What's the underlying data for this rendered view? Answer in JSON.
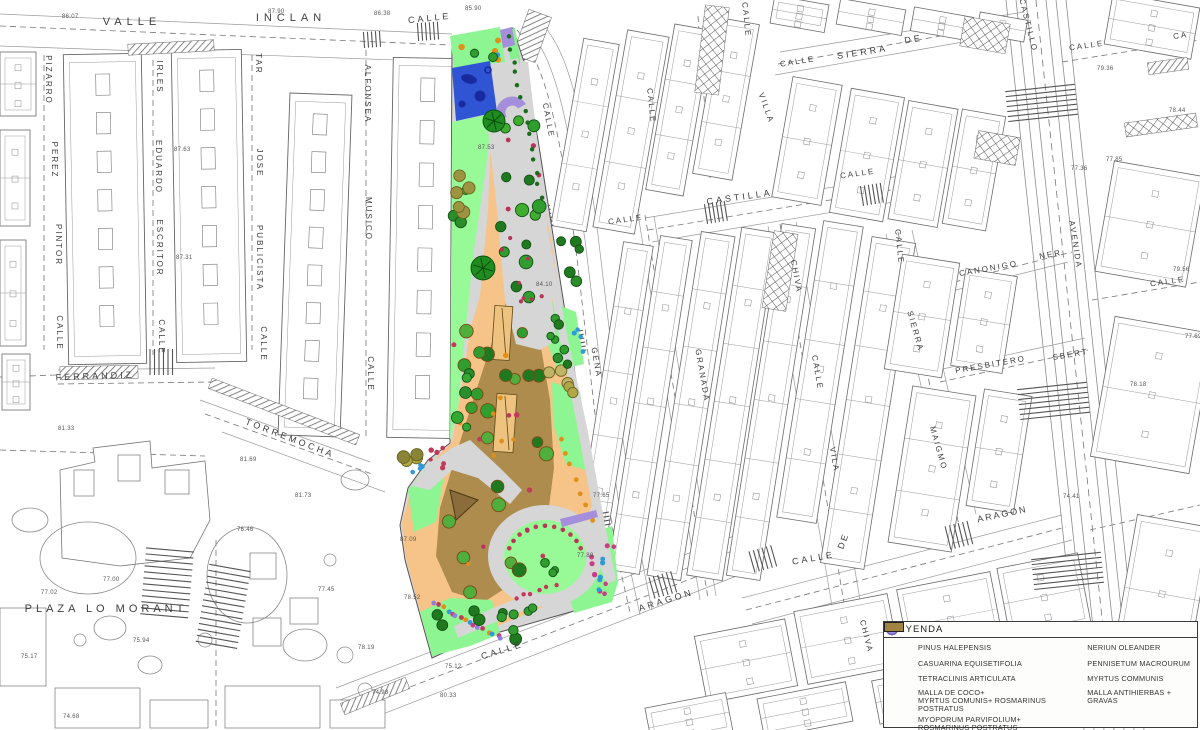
{
  "legend": {
    "title": "LEYENDA",
    "left": [
      {
        "icon": "pinus-halepensis",
        "label": "PINUS HALEPENSIS"
      },
      {
        "icon": "casuarina",
        "label": "CASUARINA EQUISETIFOLIA"
      },
      {
        "icon": "tetraclinis",
        "label": "TETRACLINIS ARTICULATA"
      },
      {
        "icon": "swatch-coco",
        "label": "MALLA DE COCO+",
        "label2": "MYRTUS COMUNIS+ ROSMARINUS POSTRATUS"
      },
      {
        "icon": "swatch-myoporum",
        "label": "MYOPORUM PARVIFOLIUM+ ROSMARINUS POSTRATUS"
      }
    ],
    "right": [
      {
        "icon": "nerium",
        "label": "NERIUN OLEANDER"
      },
      {
        "icon": "pennisetum",
        "label": "PENNISETUM MACROURUM"
      },
      {
        "icon": "myrtus",
        "label": "MYRTUS COMMUNIS"
      },
      {
        "icon": "swatch-gravas",
        "label": "MALLA ANTIHIERBAS + GRAVAS"
      }
    ],
    "icon_colors": {
      "pinus-halepensis": "#3f9e28",
      "pinus-stroke": "#1d5a12",
      "casuarina": "#ffffff",
      "casuarina-stroke": "#2d7a2d",
      "tetraclinis": "#6b6b22",
      "tetraclinis-stroke": "#3a3a10",
      "nerium": "#a83a5c",
      "nerium-stroke": "#6e1f38",
      "pennisetum": "#e09018",
      "pennisetum-stroke": "#9a6010",
      "myrtus": "#9f8fe3",
      "myrtus-stroke": "#6f5fc0",
      "swatch-coco": "#b5a057",
      "swatch-myoporum": "#14c24a",
      "swatch-gravas": "#a08243"
    }
  },
  "map": {
    "street_labels": [
      {
        "t": "VALLE",
        "x": 132,
        "y": 25,
        "r": 0,
        "s": 11,
        "ls": 5
      },
      {
        "t": "INCLAN",
        "x": 291,
        "y": 21,
        "r": 0,
        "s": 11,
        "ls": 5
      },
      {
        "t": "CALLE",
        "x": 430,
        "y": 21,
        "r": -6,
        "s": 9,
        "ls": 3
      },
      {
        "t": "PIZARRO",
        "x": 46,
        "y": 80,
        "r": 90,
        "s": 8,
        "ls": 2
      },
      {
        "t": "PEREZ",
        "x": 52,
        "y": 160,
        "r": 90,
        "s": 8,
        "ls": 2
      },
      {
        "t": "PINTOR",
        "x": 56,
        "y": 245,
        "r": 90,
        "s": 8,
        "ls": 2
      },
      {
        "t": "CALLE",
        "x": 57,
        "y": 333,
        "r": 90,
        "s": 8,
        "ls": 2
      },
      {
        "t": "IRLES",
        "x": 157,
        "y": 77,
        "r": 90,
        "s": 8,
        "ls": 2
      },
      {
        "t": "EDUARDO",
        "x": 156,
        "y": 167,
        "r": 90,
        "s": 8,
        "ls": 2
      },
      {
        "t": "ESCRITOR",
        "x": 157,
        "y": 248,
        "r": 90,
        "s": 8,
        "ls": 2
      },
      {
        "t": "CALLE",
        "x": 159,
        "y": 337,
        "r": 90,
        "s": 8,
        "ls": 2
      },
      {
        "t": "TAR",
        "x": 256,
        "y": 64,
        "r": 90,
        "s": 8,
        "ls": 2
      },
      {
        "t": "JOSE",
        "x": 257,
        "y": 163,
        "r": 90,
        "s": 8,
        "ls": 2
      },
      {
        "t": "PUBLICISTA",
        "x": 257,
        "y": 258,
        "r": 90,
        "s": 8,
        "ls": 2
      },
      {
        "t": "CALLE",
        "x": 261,
        "y": 344,
        "r": 90,
        "s": 8,
        "ls": 2
      },
      {
        "t": "ALFONSEA",
        "x": 365,
        "y": 94,
        "r": 90,
        "s": 8,
        "ls": 2
      },
      {
        "t": "MUSICO",
        "x": 366,
        "y": 219,
        "r": 90,
        "s": 8,
        "ls": 2
      },
      {
        "t": "CALLE",
        "x": 368,
        "y": 374,
        "r": 90,
        "s": 8,
        "ls": 2
      },
      {
        "t": "FERRANDIZ",
        "x": 95,
        "y": 379,
        "r": -2,
        "s": 9,
        "ls": 3
      },
      {
        "t": "TORREMOCHA",
        "x": 289,
        "y": 441,
        "r": 21,
        "s": 9,
        "ls": 3
      },
      {
        "t": "PLAZA LO MORANT",
        "x": 106,
        "y": 612,
        "r": 0,
        "s": 11,
        "ls": 4
      },
      {
        "t": "CALLE",
        "x": 546,
        "y": 121,
        "r": 79,
        "s": 8,
        "ls": 2
      },
      {
        "t": "GENA",
        "x": 594,
        "y": 363,
        "r": 80,
        "s": 8,
        "ls": 2
      },
      {
        "t": "CALLE",
        "x": 626,
        "y": 222,
        "r": -8,
        "s": 8,
        "ls": 2
      },
      {
        "t": "CALLE",
        "x": 649,
        "y": 106,
        "r": 84,
        "s": 8,
        "ls": 2
      },
      {
        "t": "CALLE",
        "x": 744,
        "y": 20,
        "r": 84,
        "s": 8,
        "ls": 2
      },
      {
        "t": "SIERRA",
        "x": 863,
        "y": 55,
        "r": -9,
        "s": 9,
        "ls": 3
      },
      {
        "t": "DE",
        "x": 914,
        "y": 42,
        "r": -9,
        "s": 9,
        "ls": 3
      },
      {
        "t": "CALLE",
        "x": 798,
        "y": 64,
        "r": -9,
        "s": 8,
        "ls": 2
      },
      {
        "t": "VILLA",
        "x": 764,
        "y": 109,
        "r": 70,
        "s": 8,
        "ls": 2
      },
      {
        "t": "CALLE",
        "x": 858,
        "y": 176,
        "r": -8,
        "s": 8,
        "ls": 2
      },
      {
        "t": "CASTILLA",
        "x": 740,
        "y": 200,
        "r": -8,
        "s": 9,
        "ls": 3
      },
      {
        "t": "CASTILLO",
        "x": 1026,
        "y": 26,
        "r": 76,
        "s": 8,
        "ls": 2
      },
      {
        "t": "CALLE",
        "x": 1087,
        "y": 48,
        "r": -8,
        "s": 8,
        "ls": 2
      },
      {
        "t": "CA",
        "x": 1181,
        "y": 38,
        "r": -8,
        "s": 8,
        "ls": 2
      },
      {
        "t": "CALLE",
        "x": 1168,
        "y": 284,
        "r": -8,
        "s": 8,
        "ls": 2
      },
      {
        "t": "CALLE",
        "x": 897,
        "y": 247,
        "r": 84,
        "s": 8,
        "ls": 2
      },
      {
        "t": "SIERRA",
        "x": 913,
        "y": 332,
        "r": 74,
        "s": 8,
        "ls": 2
      },
      {
        "t": "MAIGMO",
        "x": 936,
        "y": 449,
        "r": 74,
        "s": 8,
        "ls": 2
      },
      {
        "t": "GRANADA",
        "x": 700,
        "y": 376,
        "r": 80,
        "s": 8,
        "ls": 2
      },
      {
        "t": "CHIVA",
        "x": 794,
        "y": 277,
        "r": 80,
        "s": 8,
        "ls": 2
      },
      {
        "t": "CALLE",
        "x": 815,
        "y": 373,
        "r": 80,
        "s": 8,
        "ls": 2
      },
      {
        "t": "VILA",
        "x": 832,
        "y": 460,
        "r": 80,
        "s": 8,
        "ls": 2
      },
      {
        "t": "CANONIGO",
        "x": 989,
        "y": 271,
        "r": -10,
        "s": 8,
        "ls": 2
      },
      {
        "t": "NER",
        "x": 1051,
        "y": 257,
        "r": -10,
        "s": 8,
        "ls": 2
      },
      {
        "t": "PRESBITERO",
        "x": 991,
        "y": 367,
        "r": -10,
        "s": 8,
        "ls": 2
      },
      {
        "t": "SBERT",
        "x": 1071,
        "y": 357,
        "r": -10,
        "s": 8,
        "ls": 2
      },
      {
        "t": "AVENIDA",
        "x": 1073,
        "y": 245,
        "r": 81,
        "s": 8,
        "ls": 2
      },
      {
        "t": "CALLE",
        "x": 503,
        "y": 653,
        "r": -17,
        "s": 9,
        "ls": 3
      },
      {
        "t": "ARAGON",
        "x": 667,
        "y": 603,
        "r": -17,
        "s": 9,
        "ls": 3
      },
      {
        "t": "CALLE",
        "x": 814,
        "y": 561,
        "r": -10,
        "s": 9,
        "ls": 3
      },
      {
        "t": "DE",
        "x": 846,
        "y": 542,
        "r": -70,
        "s": 9,
        "ls": 2
      },
      {
        "t": "ARAGON",
        "x": 1003,
        "y": 517,
        "r": -12,
        "s": 9,
        "ls": 2
      },
      {
        "t": "CHIVA",
        "x": 864,
        "y": 637,
        "r": 76,
        "s": 8,
        "ls": 2
      }
    ],
    "elevations": [
      {
        "t": "86.07",
        "x": 62,
        "y": 18
      },
      {
        "t": "87.90",
        "x": 268,
        "y": 13
      },
      {
        "t": "86.38",
        "x": 374,
        "y": 15
      },
      {
        "t": "85.90",
        "x": 465,
        "y": 10
      },
      {
        "t": "87.63",
        "x": 174,
        "y": 151
      },
      {
        "t": "87.31",
        "x": 176,
        "y": 259
      },
      {
        "t": "81.33",
        "x": 58,
        "y": 430
      },
      {
        "t": "81.69",
        "x": 240,
        "y": 461
      },
      {
        "t": "81.73",
        "x": 295,
        "y": 497
      },
      {
        "t": "77.00",
        "x": 103,
        "y": 581
      },
      {
        "t": "77.02",
        "x": 41,
        "y": 594
      },
      {
        "t": "75.94",
        "x": 133,
        "y": 642
      },
      {
        "t": "75.17",
        "x": 21,
        "y": 658
      },
      {
        "t": "74.68",
        "x": 63,
        "y": 718
      },
      {
        "t": "76.46",
        "x": 237,
        "y": 531
      },
      {
        "t": "77.45",
        "x": 318,
        "y": 591
      },
      {
        "t": "78.19",
        "x": 358,
        "y": 649
      },
      {
        "t": "74.98",
        "x": 372,
        "y": 694
      },
      {
        "t": "78.52",
        "x": 404,
        "y": 599
      },
      {
        "t": "87.09",
        "x": 400,
        "y": 541
      },
      {
        "t": "80.33",
        "x": 440,
        "y": 697
      },
      {
        "t": "84.10",
        "x": 536,
        "y": 286
      },
      {
        "t": "77.80",
        "x": 577,
        "y": 557
      },
      {
        "t": "87.53",
        "x": 478,
        "y": 149
      },
      {
        "t": "75.12",
        "x": 445,
        "y": 668
      },
      {
        "t": "79.36",
        "x": 1097,
        "y": 70
      },
      {
        "t": "78.44",
        "x": 1169,
        "y": 112
      },
      {
        "t": "77.85",
        "x": 1106,
        "y": 161
      },
      {
        "t": "77.36",
        "x": 1071,
        "y": 170
      },
      {
        "t": "79.56",
        "x": 1173,
        "y": 271
      },
      {
        "t": "77.69",
        "x": 1185,
        "y": 338
      },
      {
        "t": "78.18",
        "x": 1130,
        "y": 386
      },
      {
        "t": "74.41",
        "x": 1063,
        "y": 498
      },
      {
        "t": "77.65",
        "x": 593,
        "y": 497
      }
    ]
  },
  "park": {
    "colors": {
      "path": "#d6d6d6",
      "lawn": "#97fa97",
      "lawn2": "#8ef593",
      "orange": "#f6c488",
      "gravel": "#ad8c4e",
      "play": "#2f55d4",
      "play_dark": "#182a9e",
      "purple": "#a58fdc",
      "pergola": "#eec37f"
    },
    "clusters": [
      {
        "n": 16,
        "x": 492,
        "y": 115,
        "w": 50,
        "h": 212,
        "r0": 4.5,
        "r1": 7,
        "c": [
          "#2f9e2f",
          "#1f7a1f",
          "#3fae2f"
        ],
        "s": "#145214"
      },
      {
        "n": 12,
        "x": 494,
        "y": 120,
        "w": 48,
        "h": 198,
        "r0": 1.8,
        "r1": 2.6,
        "c": [
          "#b8325a"
        ]
      },
      {
        "n": 22,
        "x": 448,
        "y": 318,
        "w": 100,
        "h": 276,
        "r0": 5,
        "r1": 7.5,
        "c": [
          "#2f9e2f",
          "#1f7a1f",
          "#4fae3c"
        ],
        "s": "#7a4a16"
      },
      {
        "n": 9,
        "x": 452,
        "y": 322,
        "w": 95,
        "h": 266,
        "r0": 2,
        "r1": 2.8,
        "c": [
          "#b8325a",
          "#c23a5a"
        ]
      },
      {
        "n": 8,
        "x": 455,
        "y": 332,
        "w": 90,
        "h": 246,
        "r0": 2,
        "r1": 2.8,
        "c": [
          "#e09018"
        ]
      },
      {
        "n": 8,
        "x": 452,
        "y": 138,
        "w": 26,
        "h": 296,
        "r0": 4,
        "r1": 6,
        "c": [
          "#33a833",
          "#2a8f2a"
        ],
        "s": "#145214"
      },
      {
        "n": 5,
        "x": 448,
        "y": 156,
        "w": 28,
        "h": 58,
        "r0": 5,
        "r1": 6.5,
        "c": [
          "#b0a847",
          "#9c9440"
        ],
        "s": "#6b6420"
      },
      {
        "n": 4,
        "x": 398,
        "y": 430,
        "w": 30,
        "h": 32,
        "r0": 5,
        "r1": 6.5,
        "c": [
          "#b0a847",
          "#8a8438"
        ],
        "s": "#6b6420"
      },
      {
        "n": 5,
        "x": 546,
        "y": 368,
        "w": 32,
        "h": 36,
        "r0": 5,
        "r1": 6.5,
        "c": [
          "#b0a847",
          "#c0b467"
        ],
        "s": "#6b6420"
      },
      {
        "n": 4,
        "x": 548,
        "y": 306,
        "w": 26,
        "h": 48,
        "r0": 3.5,
        "r1": 4.5,
        "c": [
          "#2f9e2f"
        ],
        "s": "#145214"
      },
      {
        "row": 1,
        "n": 14,
        "x1": 509,
        "y1": 36,
        "x2": 541,
        "y2": 198,
        "r": 2.2,
        "c": [
          "#1b6b1b"
        ]
      },
      {
        "row": 1,
        "n": 7,
        "x1": 560,
        "y1": 438,
        "x2": 592,
        "y2": 520,
        "r": 2.4,
        "c": [
          "#e09018"
        ]
      },
      {
        "n": 8,
        "x": 552,
        "y": 232,
        "w": 32,
        "h": 196,
        "r0": 4,
        "r1": 5.5,
        "c": [
          "#2a8f2a",
          "#1f7a1f"
        ],
        "s": "#145214"
      },
      {
        "arc": 1,
        "n": 11,
        "cx": 545,
        "cy": 560,
        "rad": 38,
        "a0": 200,
        "a1": 340,
        "r": 2.3,
        "c": [
          "#c23a5a",
          "#b8325a"
        ]
      },
      {
        "n": 3,
        "x": 530,
        "y": 562,
        "w": 30,
        "h": 24,
        "r0": 3.5,
        "r1": 4.5,
        "c": [
          "#2f9e2f"
        ],
        "s": "#145214"
      },
      {
        "row": 1,
        "n": 16,
        "x1": 434,
        "y1": 604,
        "x2": 502,
        "y2": 638,
        "r": 2.4,
        "c": [
          "#8f7fe0",
          "#c23a5a",
          "#e09018",
          "#2e9ad8",
          "#c93e87"
        ]
      },
      {
        "n": 7,
        "x": 432,
        "y": 588,
        "w": 85,
        "h": 52,
        "r0": 4.5,
        "r1": 6,
        "c": [
          "#2f9e2f",
          "#1f7a1f"
        ],
        "s": "#145214"
      },
      {
        "n": 8,
        "x": 588,
        "y": 545,
        "w": 26,
        "h": 50,
        "r0": 2,
        "r1": 2.8,
        "c": [
          "#c93e87"
        ]
      },
      {
        "n": 5,
        "x": 592,
        "y": 556,
        "w": 18,
        "h": 40,
        "r0": 2,
        "r1": 2.6,
        "c": [
          "#2e9ad8"
        ]
      },
      {
        "n": 6,
        "x": 430,
        "y": 448,
        "w": 20,
        "h": 22,
        "r0": 2,
        "r1": 2.8,
        "c": [
          "#c23a5a"
        ]
      },
      {
        "n": 4,
        "x": 412,
        "y": 462,
        "w": 14,
        "h": 16,
        "r0": 2,
        "r1": 2.5,
        "c": [
          "#2e9ad8"
        ]
      },
      {
        "n": 5,
        "x": 455,
        "y": 40,
        "w": 44,
        "h": 22,
        "r0": 2.5,
        "r1": 3.2,
        "c": [
          "#e09018"
        ]
      },
      {
        "n": 3,
        "x": 468,
        "y": 52,
        "w": 30,
        "h": 12,
        "r0": 2,
        "r1": 2.5,
        "c": [
          "#2e9ad8"
        ]
      },
      {
        "n": 4,
        "x": 570,
        "y": 300,
        "w": 24,
        "h": 58,
        "r0": 2,
        "r1": 2.6,
        "c": [
          "#2e9ad8"
        ]
      },
      {
        "row": 1,
        "n": 6,
        "x1": 516,
        "y1": 598,
        "x2": 556,
        "y2": 586,
        "r": 2.2,
        "c": [
          "#c23a5a"
        ]
      },
      {
        "n": 4,
        "x": 500,
        "y": 606,
        "w": 40,
        "h": 24,
        "r0": 4,
        "r1": 5,
        "c": [
          "#2f9e2f"
        ],
        "s": "#145214"
      },
      {
        "n": 2,
        "x": 470,
        "y": 40,
        "w": 26,
        "h": 20,
        "r0": 3.5,
        "r1": 4.5,
        "c": [
          "#2f9e2f"
        ],
        "s": "#145214"
      }
    ],
    "specimen_trees": [
      {
        "x": 494,
        "y": 121,
        "r": 11
      },
      {
        "x": 483,
        "y": 268,
        "r": 12
      }
    ]
  }
}
